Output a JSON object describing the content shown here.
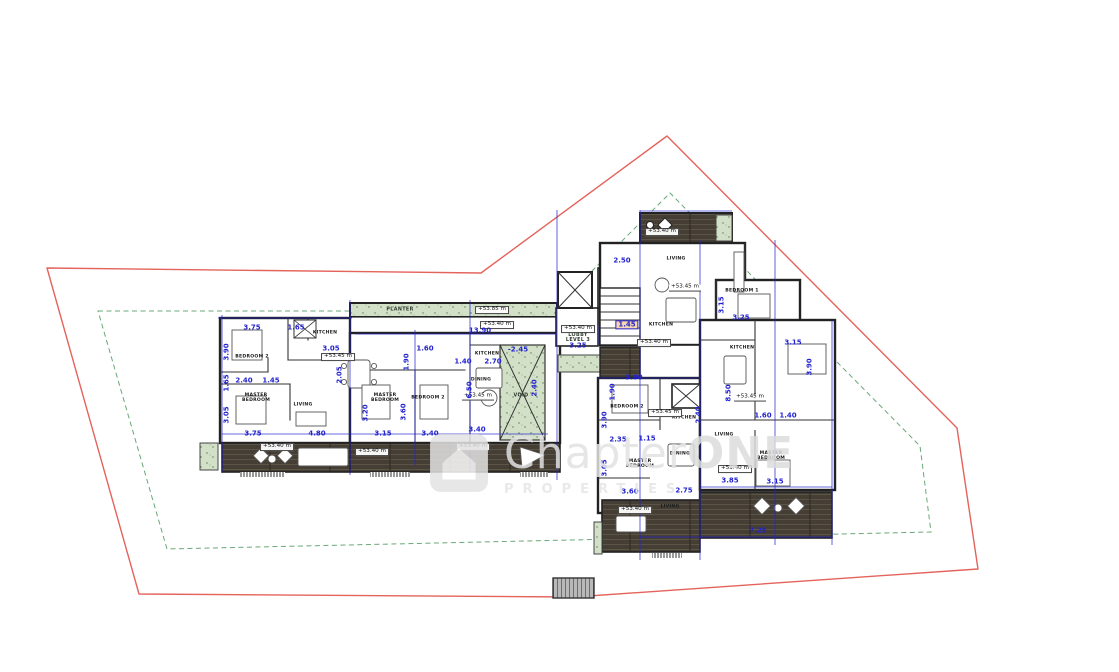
{
  "drawing": {
    "type": "architectural floor plan - level 3",
    "boundary_red_color": "#e4635b",
    "setback_green_color": "#69a877",
    "dimension_blue_color": "#2323cf",
    "deck_color": "#453e35",
    "planter_color": "#d2e0c8",
    "highlight_color": "#f7d7ae"
  },
  "watermark": {
    "brand_regular": "Chapter",
    "brand_bold": "ONE",
    "subtitle": "PROPERTIES"
  },
  "labels": {
    "rooms": [
      {
        "t": "BEDROOM 2",
        "x": 252,
        "y": 358
      },
      {
        "t": "KITCHEN",
        "x": 325,
        "y": 334
      },
      {
        "t": "MASTER BEDROOM",
        "x": 256,
        "y": 399,
        "w": 1
      },
      {
        "t": "LIVING",
        "x": 303,
        "y": 406
      },
      {
        "t": "MASTER BEDROOM",
        "x": 385,
        "y": 399,
        "w": 1
      },
      {
        "t": "BEDROOM 2",
        "x": 428,
        "y": 399
      },
      {
        "t": "KITCHEN",
        "x": 487,
        "y": 355
      },
      {
        "t": "DINING",
        "x": 481,
        "y": 381
      },
      {
        "t": "LIVING",
        "x": 676,
        "y": 260
      },
      {
        "t": "KITCHEN",
        "x": 661,
        "y": 326
      },
      {
        "t": "BEDROOM 1",
        "x": 742,
        "y": 292
      },
      {
        "t": "KITCHEN",
        "x": 742,
        "y": 349
      },
      {
        "t": "BEDROOM 2",
        "x": 627,
        "y": 408
      },
      {
        "t": "KITCHEN",
        "x": 684,
        "y": 419
      },
      {
        "t": "DINING",
        "x": 680,
        "y": 455
      },
      {
        "t": "MASTER BEDROOM",
        "x": 640,
        "y": 465,
        "w": 1
      },
      {
        "t": "LIVING",
        "x": 670,
        "y": 508
      },
      {
        "t": "LIVING",
        "x": 724,
        "y": 436
      },
      {
        "t": "MASTER BEDROOM",
        "x": 771,
        "y": 457,
        "w": 1
      }
    ],
    "areas": [
      {
        "t": "PLANTER",
        "x": 400,
        "y": 310
      },
      {
        "t": "VOID",
        "x": 521,
        "y": 396
      },
      {
        "t": "LOBBY LEVEL 3",
        "x": 578,
        "y": 338,
        "w": 1
      }
    ],
    "levels": [
      {
        "t": "+53.85 m",
        "x": 492,
        "y": 310,
        "boxed": true
      },
      {
        "t": "+53.40 m",
        "x": 497,
        "y": 325,
        "boxed": true
      },
      {
        "t": "+53.45 m",
        "x": 338,
        "y": 357,
        "boxed": true
      },
      {
        "t": "+53.45 m",
        "x": 478,
        "y": 397
      },
      {
        "t": "+53.40 m",
        "x": 277,
        "y": 447,
        "boxed": true
      },
      {
        "t": "+53.40 m",
        "x": 372,
        "y": 452,
        "boxed": true
      },
      {
        "t": "+53.40 m",
        "x": 473,
        "y": 447,
        "boxed": true
      },
      {
        "t": "+53.40 m",
        "x": 578,
        "y": 329,
        "boxed": true
      },
      {
        "t": "+53.40 m",
        "x": 654,
        "y": 343,
        "boxed": true
      },
      {
        "t": "+53.40 m",
        "x": 662,
        "y": 232,
        "boxed": true
      },
      {
        "t": "+53.45 m",
        "x": 685,
        "y": 288
      },
      {
        "t": "+53.45 m",
        "x": 665,
        "y": 413,
        "boxed": true
      },
      {
        "t": "+53.45 m",
        "x": 750,
        "y": 398
      },
      {
        "t": "+53.40 m",
        "x": 735,
        "y": 469,
        "boxed": true
      },
      {
        "t": "+53.40 m",
        "x": 635,
        "y": 510,
        "boxed": true
      }
    ],
    "dimensions": [
      {
        "t": "3.75",
        "x": 252,
        "y": 328
      },
      {
        "t": "1.65",
        "x": 296,
        "y": 328
      },
      {
        "t": "3.05",
        "x": 331,
        "y": 349
      },
      {
        "t": "2.40",
        "x": 244,
        "y": 381
      },
      {
        "t": "1.45",
        "x": 271,
        "y": 381
      },
      {
        "t": "3.75",
        "x": 253,
        "y": 434
      },
      {
        "t": "4.80",
        "x": 317,
        "y": 434
      },
      {
        "t": "3.90",
        "x": 227,
        "y": 352,
        "rot": true
      },
      {
        "t": "1.65",
        "x": 227,
        "y": 383,
        "rot": true
      },
      {
        "t": "3.05",
        "x": 227,
        "y": 415,
        "rot": true
      },
      {
        "t": "2.05",
        "x": 340,
        "y": 375,
        "rot": true
      },
      {
        "t": "3.15",
        "x": 383,
        "y": 434
      },
      {
        "t": "3.40",
        "x": 430,
        "y": 434
      },
      {
        "t": "1.60",
        "x": 425,
        "y": 349
      },
      {
        "t": "3.20",
        "x": 366,
        "y": 413,
        "rot": true
      },
      {
        "t": "1.90",
        "x": 407,
        "y": 362,
        "rot": true
      },
      {
        "t": "3.60",
        "x": 404,
        "y": 412,
        "rot": true
      },
      {
        "t": "1.40",
        "x": 463,
        "y": 362
      },
      {
        "t": "2.70",
        "x": 493,
        "y": 362
      },
      {
        "t": "6.50",
        "x": 470,
        "y": 390,
        "rot": true
      },
      {
        "t": "3.40",
        "x": 477,
        "y": 430
      },
      {
        "t": "-2.45",
        "x": 518,
        "y": 350
      },
      {
        "t": "2.40",
        "x": 535,
        "y": 388,
        "rot": true
      },
      {
        "t": "13.90",
        "x": 480,
        "y": 331
      },
      {
        "t": "3.25",
        "x": 578,
        "y": 346
      },
      {
        "t": "1.45",
        "x": 627,
        "y": 325,
        "hl": true
      },
      {
        "t": "2.50",
        "x": 622,
        "y": 261
      },
      {
        "t": "3.00",
        "x": 634,
        "y": 378
      },
      {
        "t": "1.90",
        "x": 613,
        "y": 392,
        "rot": true
      },
      {
        "t": "3.15",
        "x": 722,
        "y": 305,
        "rot": true
      },
      {
        "t": "3.25",
        "x": 741,
        "y": 318
      },
      {
        "t": "3.15",
        "x": 793,
        "y": 343
      },
      {
        "t": "3.90",
        "x": 810,
        "y": 367,
        "rot": true
      },
      {
        "t": "1.60",
        "x": 763,
        "y": 416
      },
      {
        "t": "1.40",
        "x": 788,
        "y": 416
      },
      {
        "t": "3.15",
        "x": 775,
        "y": 482
      },
      {
        "t": "3.85",
        "x": 730,
        "y": 481
      },
      {
        "t": "7.25",
        "x": 758,
        "y": 531
      },
      {
        "t": "8.50",
        "x": 729,
        "y": 393,
        "rot": true
      },
      {
        "t": "2.40",
        "x": 699,
        "y": 415,
        "rot": true
      },
      {
        "t": "2.35",
        "x": 618,
        "y": 440
      },
      {
        "t": "1.15",
        "x": 647,
        "y": 439
      },
      {
        "t": "3.60",
        "x": 630,
        "y": 492
      },
      {
        "t": "2.75",
        "x": 684,
        "y": 491
      },
      {
        "t": "3.90",
        "x": 605,
        "y": 420,
        "rot": true
      },
      {
        "t": "3.05",
        "x": 605,
        "y": 468,
        "rot": true
      }
    ]
  }
}
